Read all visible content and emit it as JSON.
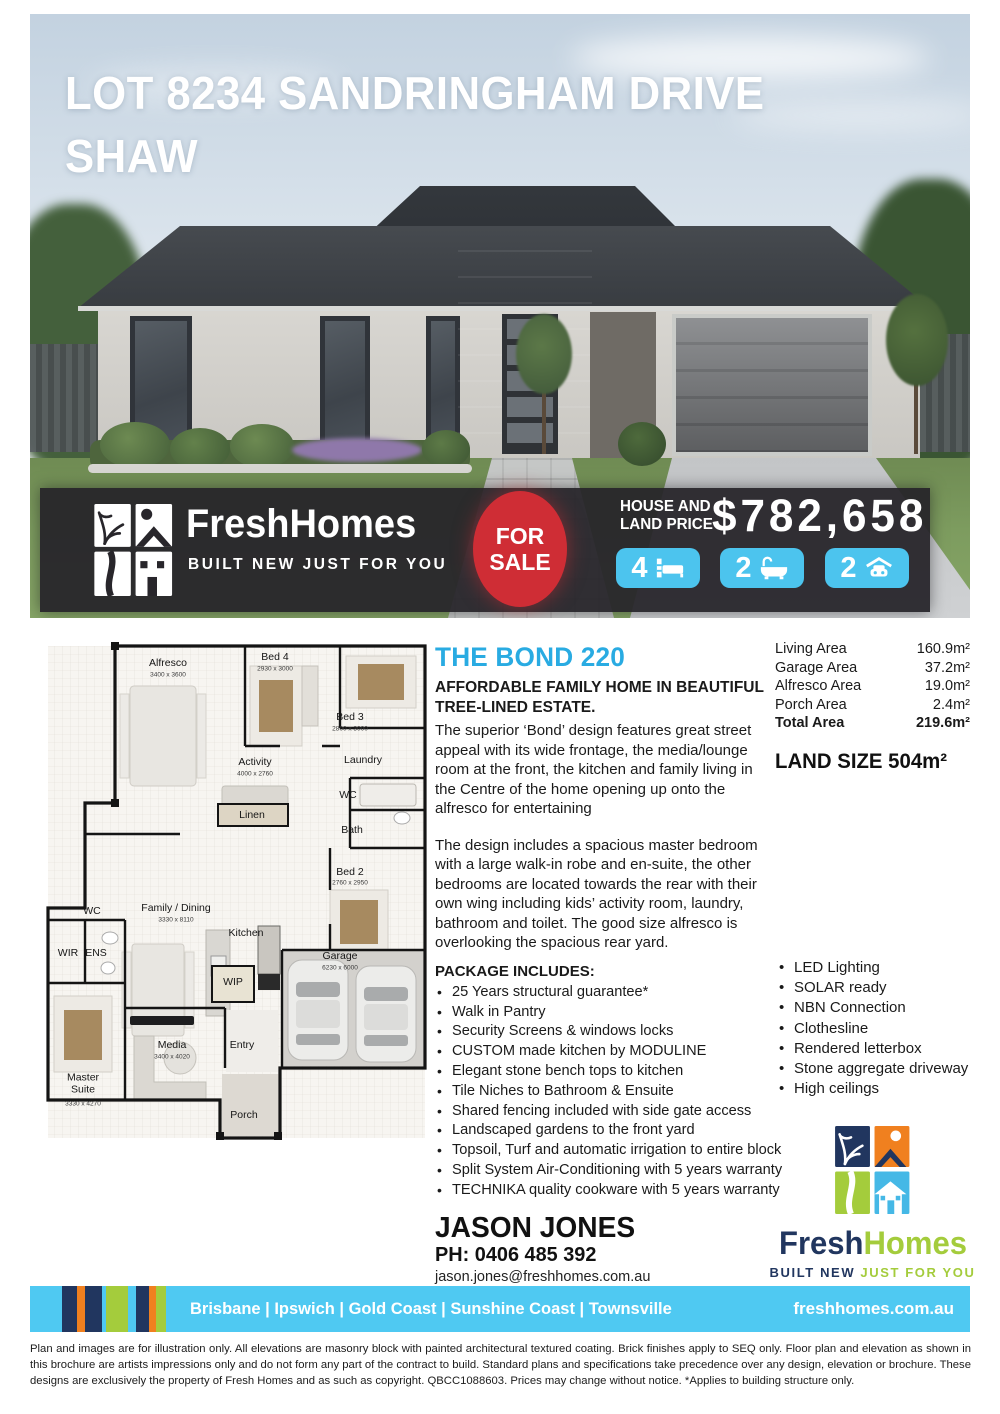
{
  "hero": {
    "title_line1": "LOT 8234 SANDRINGHAM DRIVE",
    "title_line2": "SHAW"
  },
  "banner": {
    "brand_fresh": "Fresh",
    "brand_homes": "Homes",
    "tagline": "BUILT NEW JUST FOR YOU",
    "for_sale_line1": "FOR",
    "for_sale_line2": "SALE",
    "price_label_line1": "HOUSE AND",
    "price_label_line2": "LAND PRICE",
    "price": "$782,658",
    "beds": "4",
    "baths": "2",
    "cars": "2"
  },
  "floorplan": {
    "rooms": [
      {
        "name": "Alfresco",
        "dims": "3400 x 3600"
      },
      {
        "name": "Bed 4",
        "dims": "2930 x 3000"
      },
      {
        "name": "Bed 3",
        "dims": "2800 x 3000"
      },
      {
        "name": "Activity",
        "dims": "4000 x 2760"
      },
      {
        "name": "Laundry"
      },
      {
        "name": "WC"
      },
      {
        "name": "Linen"
      },
      {
        "name": "Bath"
      },
      {
        "name": "Bed 2",
        "dims": "2760 x 2950"
      },
      {
        "name": "Family / Dining",
        "dims": "3330 x 8110"
      },
      {
        "name": "WC"
      },
      {
        "name": "Kitchen"
      },
      {
        "name": "WIR"
      },
      {
        "name": "ENS"
      },
      {
        "name": "WIP"
      },
      {
        "name": "Garage",
        "dims": "6230 x 6000"
      },
      {
        "name": "Media",
        "dims": "3400 x 4020"
      },
      {
        "name": "Entry"
      },
      {
        "name": "Master Suite",
        "dims": "3330 x 4270"
      },
      {
        "name": "Porch"
      }
    ]
  },
  "main": {
    "design_name": "THE BOND 220",
    "subheading": "AFFORDABLE FAMILY HOME IN BEAUTIFUL TREE-LINED ESTATE.",
    "para1": "The superior ‘Bond’ design features great street appeal with its wide frontage, the media/lounge room at the front, the kitchen and family living in the Centre of the home opening up onto the alfresco for entertaining",
    "para2": "The design includes a spacious master bedroom with a large walk-in robe and en-suite, the other bedrooms are located towards the rear with their own wing including kids’ activity room, laundry, bathroom and toilet. The good size alfresco is overlooking the spacious rear yard.",
    "package_heading": "PACKAGE INCLUDES:",
    "package_items": [
      "25 Years structural guarantee*",
      "Walk in Pantry",
      "Security Screens & windows locks",
      "CUSTOM made kitchen by MODULINE",
      "Elegant stone bench tops to kitchen",
      "Tile Niches to Bathroom & Ensuite",
      "Shared fencing included with side gate access",
      "Landscaped gardens to the front yard",
      "Topsoil, Turf and automatic irrigation to entire block",
      "Split System Air-Conditioning with 5 years warranty",
      "TECHNIKA quality cookware with 5 years warranty"
    ]
  },
  "areas": {
    "rows": [
      {
        "label": "Living Area",
        "value": "160.9m²"
      },
      {
        "label": "Garage Area",
        "value": "37.2m²"
      },
      {
        "label": "Alfresco Area",
        "value": "19.0m²"
      },
      {
        "label": "Porch Area",
        "value": "2.4m²"
      },
      {
        "label": "Total Area",
        "value": "219.6m²"
      }
    ],
    "land_size": "LAND SIZE 504m²"
  },
  "features": [
    "LED Lighting",
    "SOLAR ready",
    "NBN Connection",
    "Clothesline",
    "Rendered letterbox",
    "Stone aggregate driveway",
    "High ceilings"
  ],
  "contact": {
    "name": "JASON JONES",
    "phone": "PH: 0406 485 392",
    "email": "jason.jones@freshhomes.com.au"
  },
  "logo": {
    "fresh": "Fresh",
    "homes": "Homes",
    "tagline_built": "BUILT NEW",
    "tagline_rest": " JUST FOR YOU"
  },
  "footer": {
    "locations": "Brisbane | Ipswich | Gold Coast | Sunshine Coast | Townsville",
    "website": "freshhomes.com.au"
  },
  "disclaimer": "Plan and images are for illustration only. All elevations are masonry block with painted architectural textured coating. Brick finishes apply to SEQ only. Floor plan and elevation as shown in this brochure are artists impressions only and do not form any part of the contract to build. Standard plans and specifications take precedence over any design, elevation or brochure. These designs are exclusively the property of Fresh Homes and as such as copyright. QBCC1088603. Prices may change without notice. *Applies to building structure only.",
  "colors": {
    "accent_blue": "#29ABE2",
    "pill_blue": "#4CC4EE",
    "sale_red": "#CF2D35",
    "navy": "#21365F",
    "green": "#A4CC3C",
    "orange": "#F0801F",
    "footer_blue": "#4FC9F2"
  }
}
